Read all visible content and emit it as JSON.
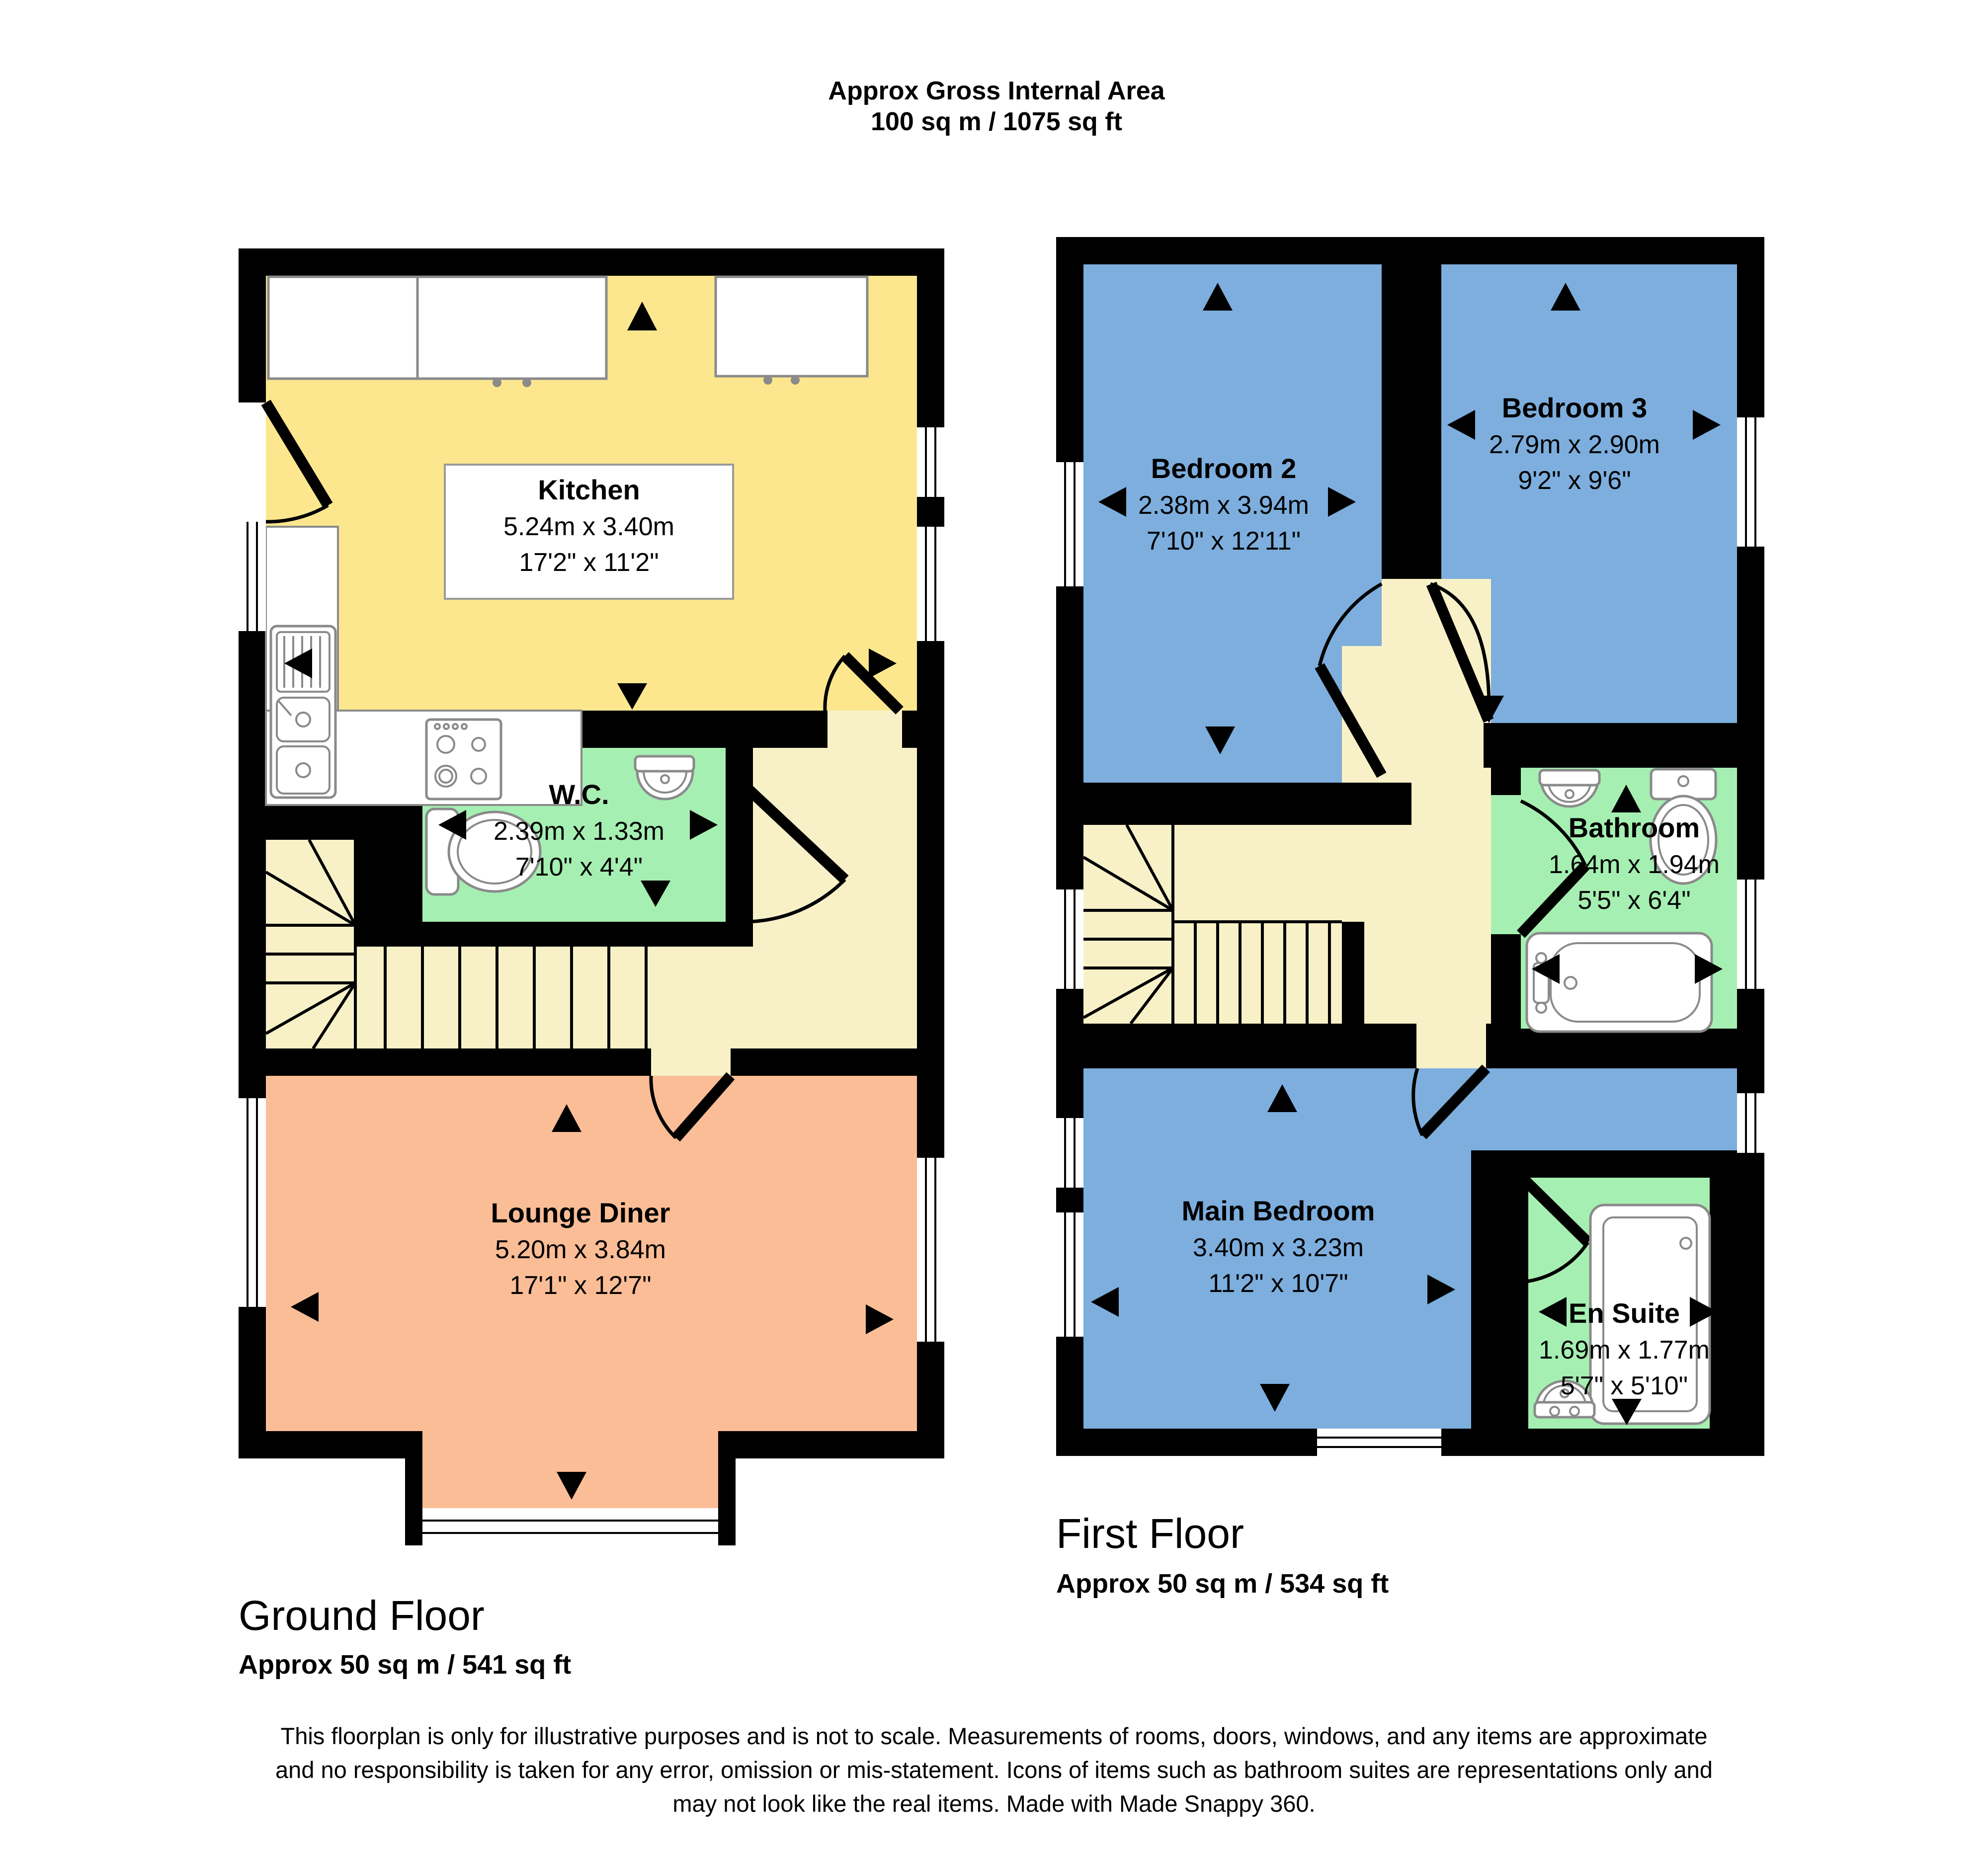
{
  "header": {
    "title": "Approx Gross Internal Area",
    "area": "100 sq m / 1075 sq ft"
  },
  "floors": {
    "ground": {
      "label": "Ground Floor",
      "area": "Approx 50 sq m / 541 sq ft"
    },
    "first": {
      "label": "First Floor",
      "area": "Approx 50 sq m / 534 sq ft"
    }
  },
  "rooms": {
    "kitchen": {
      "name": "Kitchen",
      "metric": "5.24m x 3.40m",
      "imperial": "17'2\" x 11'2\""
    },
    "wc": {
      "name": "W.C.",
      "metric": "2.39m x 1.33m",
      "imperial": "7'10\" x 4'4\""
    },
    "lounge": {
      "name": "Lounge Diner",
      "metric": "5.20m x 3.84m",
      "imperial": "17'1\" x 12'7\""
    },
    "bedroom2": {
      "name": "Bedroom 2",
      "metric": "2.38m x 3.94m",
      "imperial": "7'10\" x 12'11\""
    },
    "bedroom3": {
      "name": "Bedroom 3",
      "metric": "2.79m x 2.90m",
      "imperial": "9'2\" x 9'6\""
    },
    "bathroom": {
      "name": "Bathroom",
      "metric": "1.64m x 1.94m",
      "imperial": "5'5\" x 6'4\""
    },
    "main_bedroom": {
      "name": "Main Bedroom",
      "metric": "3.40m x 3.23m",
      "imperial": "11'2\" x 10'7\""
    },
    "ensuite": {
      "name": "En Suite",
      "metric": "1.69m x 1.77m",
      "imperial": "5'7\" x 5'10\""
    }
  },
  "footer": {
    "line1": "This floorplan is only for illustrative purposes and is not to scale. Measurements of rooms, doors, windows, and any items are approximate",
    "line2": "and no responsibility is taken for any error, omission or mis-statement. Icons of items such as bathroom suites are representations only and",
    "line3": "may not look like the real items. Made with Made Snappy 360."
  },
  "colors": {
    "wall": "#000000",
    "kitchen": "#FCE78E",
    "hall": "#F8F1C8",
    "wet_room": "#A6EFB2",
    "bedroom": "#7DAEDD",
    "lounge": "#FBBD96",
    "white": "#FFFFFF"
  }
}
